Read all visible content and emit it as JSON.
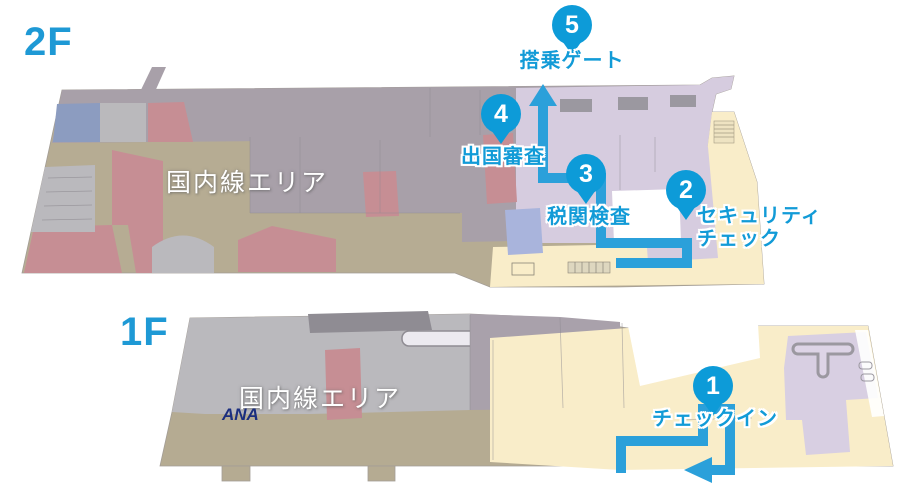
{
  "map": {
    "floors": [
      {
        "label": "2F",
        "area_label": "国内線エリア"
      },
      {
        "label": "1F",
        "area_label": "国内線エリア"
      }
    ],
    "steps": [
      {
        "number": "1",
        "label": "チェックイン"
      },
      {
        "number": "2",
        "label": "セキュリティ\nチェック"
      },
      {
        "number": "3",
        "label": "税関検査"
      },
      {
        "number": "4",
        "label": "出国審査"
      },
      {
        "number": "5",
        "label": "搭乗ゲート"
      }
    ],
    "logos": {
      "ana": "ANA"
    },
    "colors": {
      "route_blue": "#2ba0da",
      "pin_blue": "#0d9bd8",
      "label_blue": "#129bd7",
      "floor_label_blue": "#1e99d5",
      "ana_navy": "#1b2e7f"
    }
  }
}
